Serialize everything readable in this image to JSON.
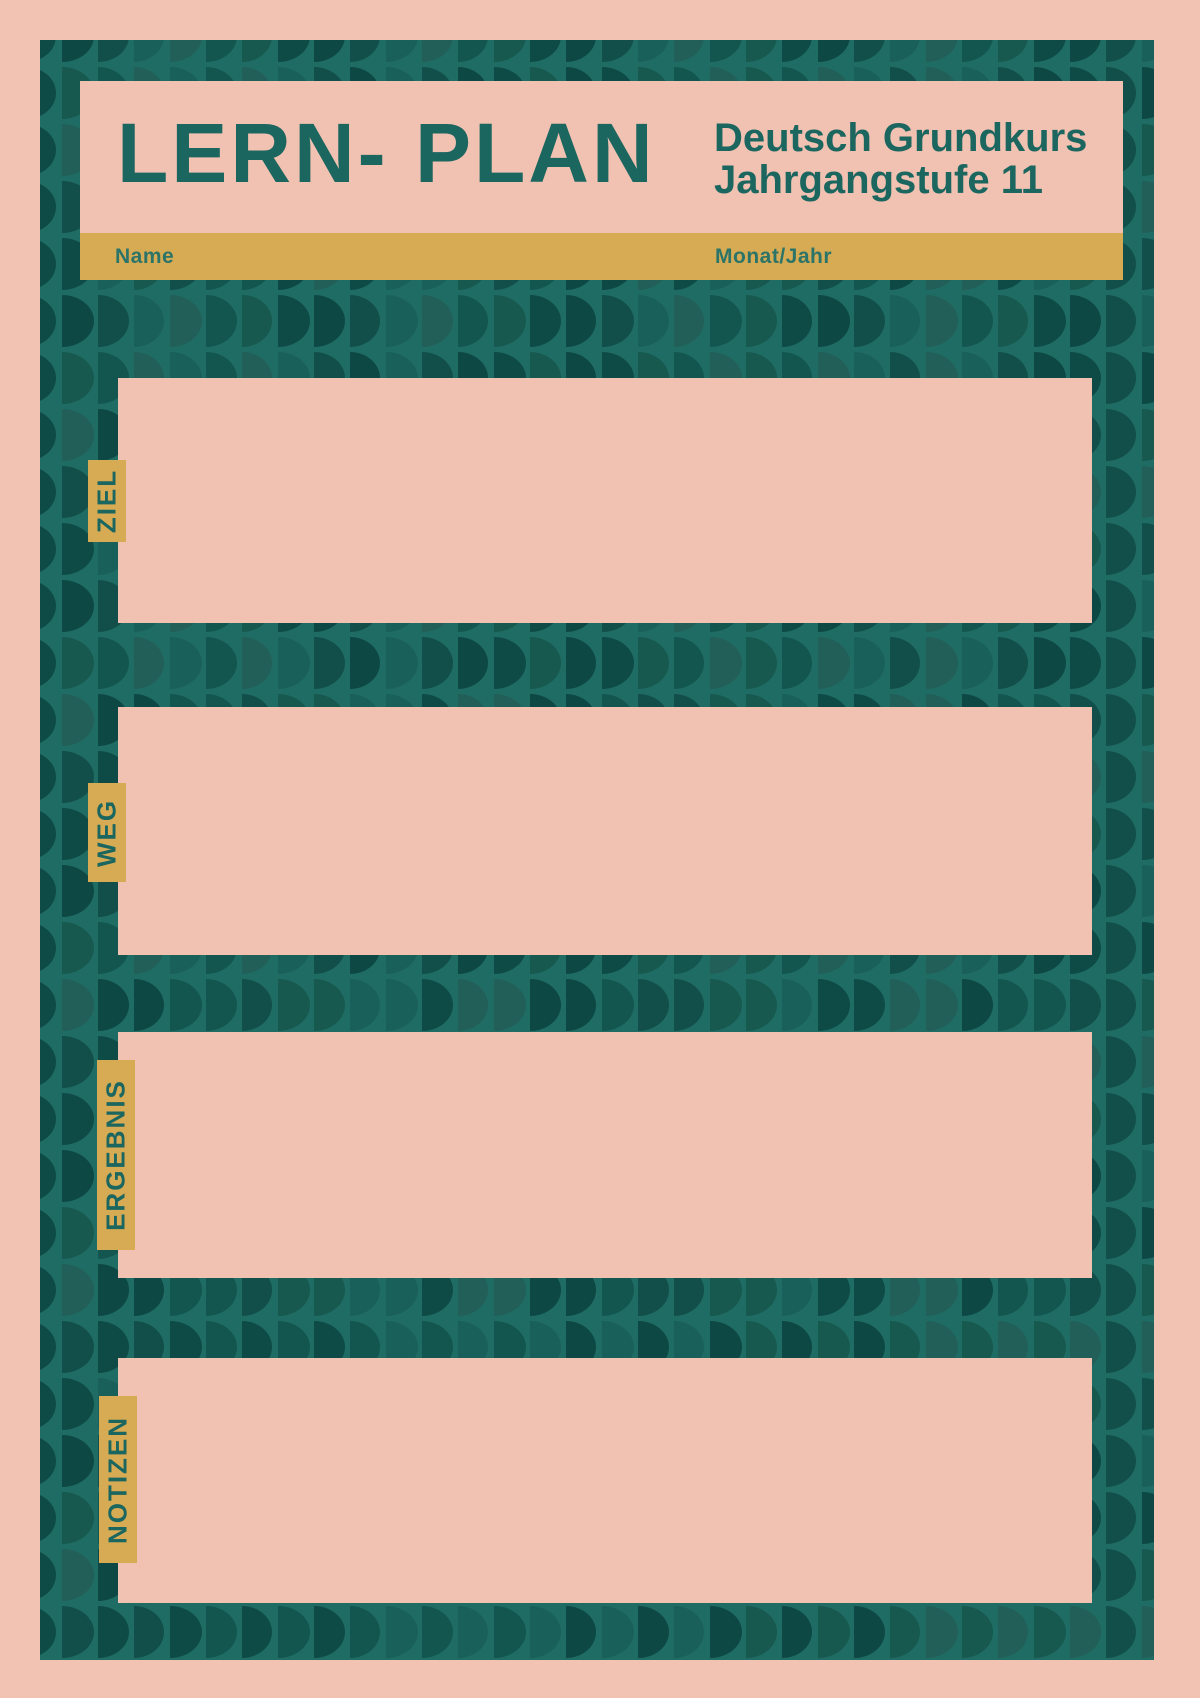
{
  "document": {
    "type": "learning-plan-worksheet",
    "language": "de"
  },
  "header": {
    "title": "LERN- PLAN",
    "subtitle_line1": "Deutsch Grundkurs",
    "subtitle_line2": "Jahrgangstufe 11"
  },
  "meta_bar": {
    "name_label": "Name",
    "month_year_label": "Monat/Jahr"
  },
  "sections": [
    {
      "label": "ZIEL"
    },
    {
      "label": "WEG"
    },
    {
      "label": "ERGEBNIS"
    },
    {
      "label": "NOTIZEN"
    }
  ],
  "colors": {
    "pink": "#f2c2b2",
    "boxpink": "#f1c1b1",
    "teal": "#1f6c64",
    "gold": "#d7ab53",
    "textteal": "#1c6660",
    "labelteal": "#2c7468",
    "pattern_shades": [
      "#0e4b47",
      "#135650",
      "#1a605a",
      "#0d4845",
      "#17594f",
      "#225f58",
      "#124f4a"
    ]
  }
}
